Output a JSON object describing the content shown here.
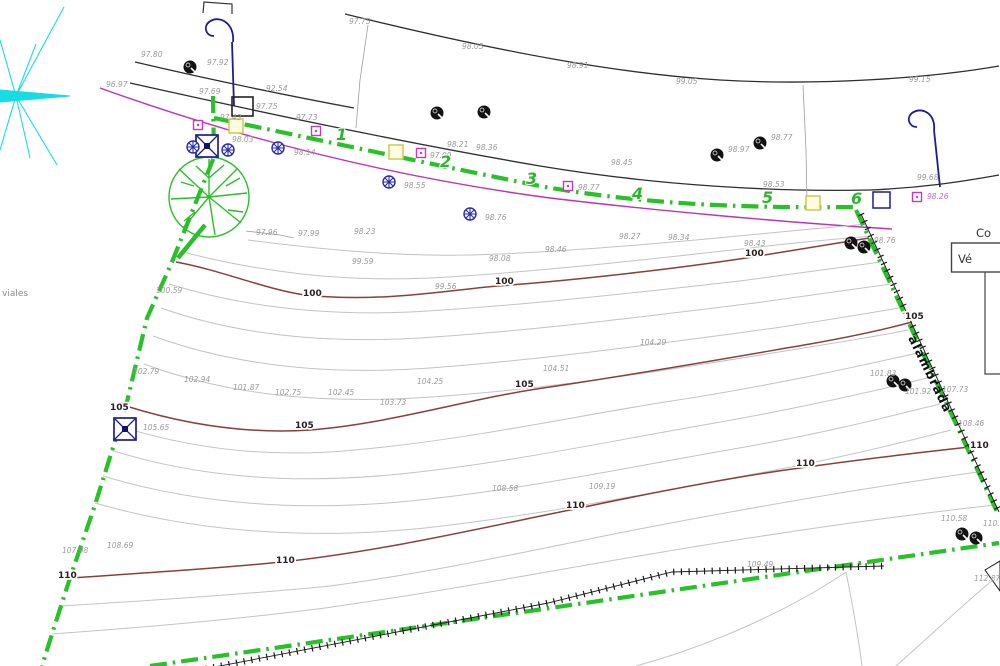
{
  "texts": {
    "viales": "viales",
    "alambrada": "alambrada",
    "table_title": "Co",
    "table_header": "Vé"
  },
  "colors": {
    "boundary_green": "#28c128",
    "contour_index_maroon": "#8a4038",
    "contour_minor_gray": "#c3c3c3",
    "utility_magenta": "#bb33bb",
    "lamp_navy": "#1c1c96",
    "compass_cyan": "#17dce4",
    "spot_label_gray": "#9a9a9a"
  },
  "vertex_labels": [
    {
      "text": "1",
      "x": 336,
      "y": 140
    },
    {
      "text": "2",
      "x": 440,
      "y": 167
    },
    {
      "text": "3",
      "x": 526,
      "y": 184
    },
    {
      "text": "4",
      "x": 632,
      "y": 199
    },
    {
      "text": "5",
      "x": 762,
      "y": 203
    },
    {
      "text": "6",
      "x": 851,
      "y": 204
    }
  ],
  "contour_labels": [
    {
      "text": "100",
      "x": 303,
      "y": 296
    },
    {
      "text": "100",
      "x": 495,
      "y": 284
    },
    {
      "text": "100",
      "x": 745,
      "y": 256
    },
    {
      "text": "105",
      "x": 110,
      "y": 410
    },
    {
      "text": "105",
      "x": 295,
      "y": 428
    },
    {
      "text": "105",
      "x": 515,
      "y": 387
    },
    {
      "text": "105",
      "x": 905,
      "y": 319
    },
    {
      "text": "110",
      "x": 58,
      "y": 578
    },
    {
      "text": "110",
      "x": 276,
      "y": 563
    },
    {
      "text": "110",
      "x": 566,
      "y": 508
    },
    {
      "text": "110",
      "x": 796,
      "y": 466
    },
    {
      "text": "110",
      "x": 970,
      "y": 448
    }
  ],
  "spot_labels": [
    {
      "text": "97.80",
      "x": 141,
      "y": 57
    },
    {
      "text": "97.75",
      "x": 349,
      "y": 24
    },
    {
      "text": "98.05",
      "x": 462,
      "y": 49
    },
    {
      "text": "98.91",
      "x": 567,
      "y": 68
    },
    {
      "text": "99.05",
      "x": 676,
      "y": 84
    },
    {
      "text": "99.15",
      "x": 909,
      "y": 82
    },
    {
      "text": "97.92",
      "x": 207,
      "y": 65
    },
    {
      "text": "92.54",
      "x": 266,
      "y": 91
    },
    {
      "text": "97.69",
      "x": 199,
      "y": 94
    },
    {
      "text": "97.75",
      "x": 256,
      "y": 109
    },
    {
      "text": "97.43",
      "x": 220,
      "y": 120
    },
    {
      "text": "98.03",
      "x": 232,
      "y": 142
    },
    {
      "text": "97.73",
      "x": 296,
      "y": 120
    },
    {
      "text": "98.21",
      "x": 447,
      "y": 147
    },
    {
      "text": "98.36",
      "x": 476,
      "y": 150
    },
    {
      "text": "97.09",
      "x": 430,
      "y": 158
    },
    {
      "text": "98.77",
      "x": 578,
      "y": 190
    },
    {
      "text": "98.45",
      "x": 611,
      "y": 165
    },
    {
      "text": "98.53",
      "x": 763,
      "y": 187
    },
    {
      "text": "98.26",
      "x": 927,
      "y": 199,
      "style": "fill:#cc66cc"
    },
    {
      "text": "99.68",
      "x": 917,
      "y": 180
    },
    {
      "text": "98.97",
      "x": 728,
      "y": 152
    },
    {
      "text": "98.77",
      "x": 771,
      "y": 140
    },
    {
      "text": "98.14",
      "x": 294,
      "y": 155
    },
    {
      "text": "98.55",
      "x": 404,
      "y": 188
    },
    {
      "text": "98.76",
      "x": 485,
      "y": 220
    },
    {
      "text": "96.97",
      "x": 106,
      "y": 87
    },
    {
      "text": "97.96",
      "x": 256,
      "y": 235
    },
    {
      "text": "97.99",
      "x": 298,
      "y": 236
    },
    {
      "text": "98.23",
      "x": 354,
      "y": 234
    },
    {
      "text": "98.27",
      "x": 619,
      "y": 239
    },
    {
      "text": "98.34",
      "x": 668,
      "y": 240
    },
    {
      "text": "98.76",
      "x": 874,
      "y": 243
    },
    {
      "text": "98.46",
      "x": 545,
      "y": 252
    },
    {
      "text": "98.08",
      "x": 489,
      "y": 261
    },
    {
      "text": "99.59",
      "x": 352,
      "y": 264
    },
    {
      "text": "98.43",
      "x": 744,
      "y": 246
    },
    {
      "text": "100.59",
      "x": 156,
      "y": 293
    },
    {
      "text": "99.56",
      "x": 435,
      "y": 289
    },
    {
      "text": "104.29",
      "x": 640,
      "y": 345
    },
    {
      "text": "102.79",
      "x": 133,
      "y": 374
    },
    {
      "text": "102.94",
      "x": 184,
      "y": 382
    },
    {
      "text": "101.87",
      "x": 233,
      "y": 390
    },
    {
      "text": "102.75",
      "x": 275,
      "y": 395
    },
    {
      "text": "102.45",
      "x": 328,
      "y": 395
    },
    {
      "text": "103.73",
      "x": 380,
      "y": 405
    },
    {
      "text": "104.51",
      "x": 543,
      "y": 371
    },
    {
      "text": "104.25",
      "x": 417,
      "y": 384
    },
    {
      "text": "105.65",
      "x": 143,
      "y": 430
    },
    {
      "text": "107.73",
      "x": 942,
      "y": 392
    },
    {
      "text": "108.46",
      "x": 958,
      "y": 426
    },
    {
      "text": "108.58",
      "x": 492,
      "y": 491
    },
    {
      "text": "109.19",
      "x": 589,
      "y": 489
    },
    {
      "text": "108.69",
      "x": 107,
      "y": 548
    },
    {
      "text": "107.98",
      "x": 62,
      "y": 553
    },
    {
      "text": "110.58",
      "x": 941,
      "y": 521
    },
    {
      "text": "110.69",
      "x": 983,
      "y": 526
    },
    {
      "text": "112.87",
      "x": 974,
      "y": 581
    },
    {
      "text": "109.49",
      "x": 747,
      "y": 567
    },
    {
      "text": "101.83",
      "x": 870,
      "y": 376
    },
    {
      "text": "101.92",
      "x": 905,
      "y": 394
    }
  ],
  "monuments": [
    {
      "x": 207,
      "y": 146
    },
    {
      "x": 125,
      "y": 429
    }
  ],
  "benchmarks": [
    {
      "x": 193,
      "y": 147
    },
    {
      "x": 228,
      "y": 150
    },
    {
      "x": 278,
      "y": 148
    },
    {
      "x": 389,
      "y": 182
    },
    {
      "x": 470,
      "y": 214
    }
  ],
  "point_trees": [
    {
      "x": 190,
      "y": 67
    },
    {
      "x": 437,
      "y": 113
    },
    {
      "x": 484,
      "y": 112
    },
    {
      "x": 717,
      "y": 155
    },
    {
      "x": 760,
      "y": 143
    },
    {
      "x": 851,
      "y": 243
    },
    {
      "x": 864,
      "y": 247
    },
    {
      "x": 893,
      "y": 381
    },
    {
      "x": 905,
      "y": 385
    },
    {
      "x": 962,
      "y": 534
    },
    {
      "x": 976,
      "y": 538
    }
  ],
  "magenta_boxes": [
    {
      "x": 198,
      "y": 125
    },
    {
      "x": 316,
      "y": 131
    },
    {
      "x": 421,
      "y": 153
    },
    {
      "x": 568,
      "y": 186
    },
    {
      "x": 917,
      "y": 197
    }
  ],
  "yellow_boxes": [
    {
      "x": 236,
      "y": 126
    },
    {
      "x": 396,
      "y": 152
    },
    {
      "x": 813,
      "y": 203
    }
  ]
}
